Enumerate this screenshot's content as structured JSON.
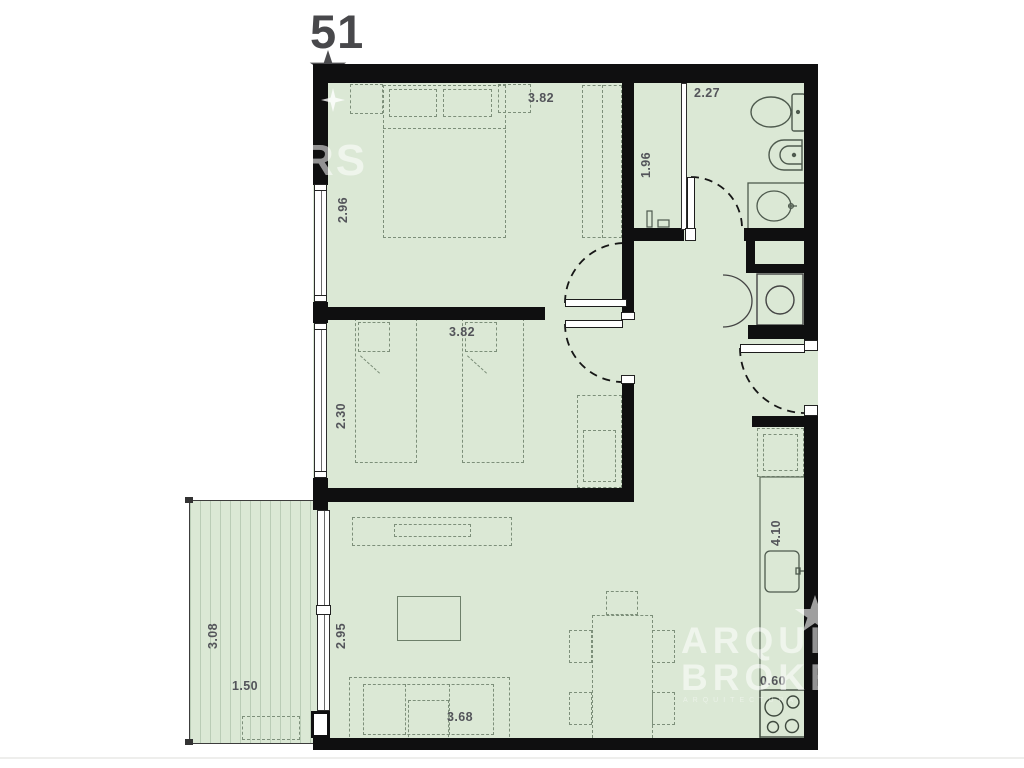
{
  "title": {
    "unit_number": "51"
  },
  "dimensions": {
    "bedroom1_width": "3.82",
    "bedroom1_depth": "2.96",
    "bathroom_width": "2.27",
    "shower_length": "1.96",
    "bedroom2_width": "3.82",
    "bedroom2_depth": "2.30",
    "balcony_depth": "3.08",
    "balcony_width": "1.50",
    "living_width": "2.95",
    "living_length": "3.68",
    "kitchen_length": "4.10",
    "kitchen_depth": "0.60"
  },
  "watermark": {
    "partial_text": "RS",
    "brand_line1": "ARQUI",
    "brand_line2": "BROKE",
    "tagline": "ARQUITECTURA"
  },
  "colors": {
    "floor": "#dbe8d5",
    "wall": "#0f0f10",
    "dimension_text": "#53545a",
    "furniture_line": "#7d8f7a"
  }
}
